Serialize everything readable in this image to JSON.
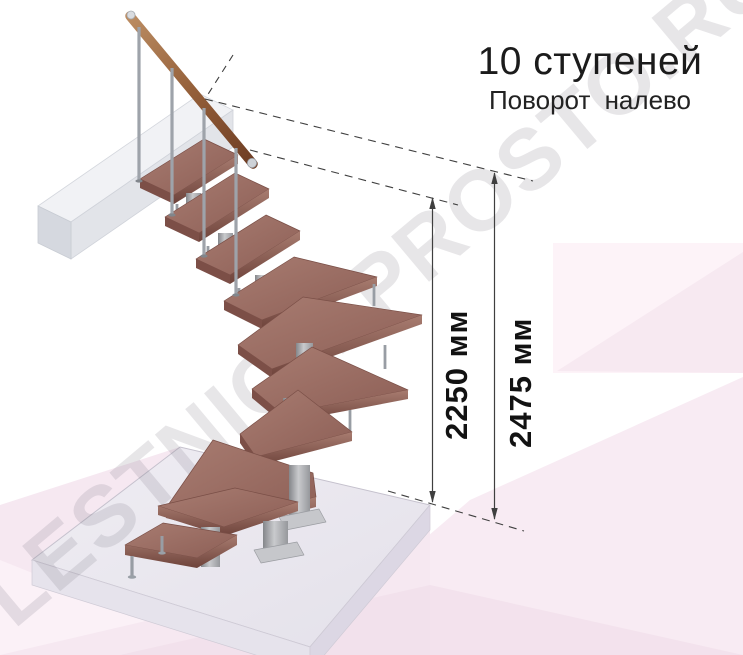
{
  "title": {
    "text": "10 ступеней"
  },
  "subtitle": {
    "text": "Поворот налево"
  },
  "watermark": {
    "text": "LESTNICA-PROSTO.RU"
  },
  "annotations": {
    "dim_stair_height": {
      "text": "2250 мм",
      "value": 2250,
      "unit": "мм"
    },
    "dim_total_height": {
      "text": "2475 мм",
      "value": 2475,
      "unit": "мм"
    }
  },
  "illustration": {
    "subject": "модульная лестница, 10 ступеней, поворот налево",
    "step_count": 10,
    "turn_direction": "налево"
  },
  "colors": {
    "wood_tread": "#9a6c62",
    "handrail_wood": "#95603a",
    "metal": "#b4b6ba",
    "floor_slab": "#eae8ef",
    "background_pink": "#f7e9f2",
    "dimension_line": "#3f3f3f",
    "text": "#1a1a1a",
    "watermark_gray": "#8b8690"
  }
}
